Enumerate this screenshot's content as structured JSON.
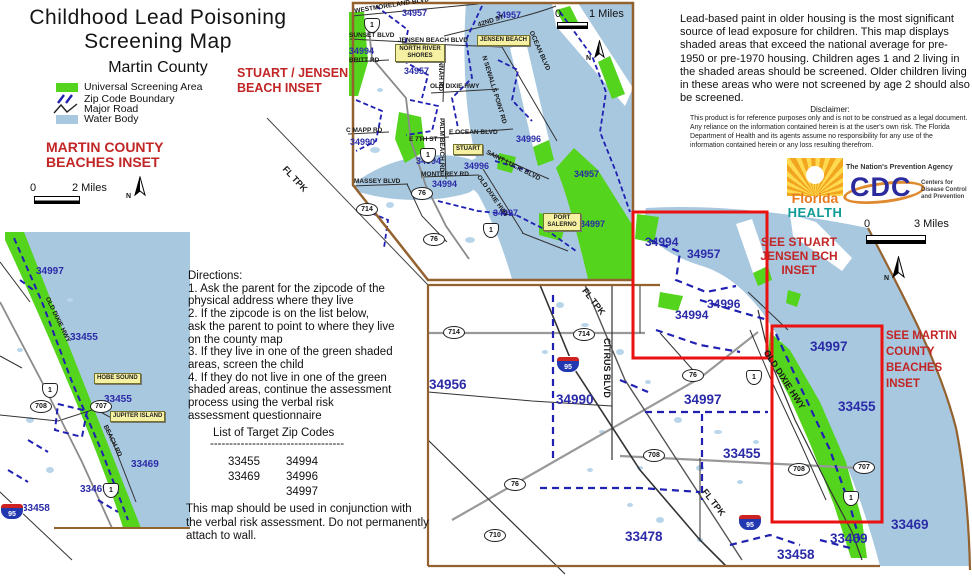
{
  "title": {
    "line1": "Childhood Lead Poisoning",
    "line2": "Screening Map",
    "subtitle": "Martin County"
  },
  "legend": {
    "universal": "Universal Screening Area",
    "zip": "Zip Code Boundary",
    "road": "Major Road",
    "water": "Water Body"
  },
  "misc": {
    "north": "N"
  },
  "beaches_inset": {
    "title1": "MARTIN COUNTY",
    "title2": "BEACHES INSET",
    "scale0": "0",
    "scale_label": "2  Miles",
    "zips": [
      "34997",
      "33455",
      "33455",
      "33469",
      "33469",
      "33458"
    ],
    "roads": [
      "OLD DIXIE HWY",
      "BEACH RD"
    ],
    "places": [
      "HOBE SOUND",
      "JUPITER ISLAND"
    ]
  },
  "stuart_inset": {
    "title1": "STUART / JENSEN",
    "title2": "BEACH INSET",
    "scale0": "0",
    "scale_label": "1  Miles",
    "zips": [
      "34957",
      "34957",
      "34994",
      "34957",
      "34990",
      "34994",
      "34996",
      "34996",
      "34994",
      "34957",
      "34997",
      "34997"
    ],
    "roads": [
      "WESTMORELAND BLVD",
      "42ND ST",
      "SUNSET BLVD",
      "JENSEN BEACH BLVD",
      "BRITT RD",
      "SAVANNAH RD",
      "OLD DIXIE HWY",
      "N SEWALLS POINT RD",
      "OCEAN BLVD",
      "C MAPP RD",
      "MASSEY BLVD",
      "E 7TH ST",
      "E OCEAN BLVD",
      "MONTEREY RD",
      "PALM BEACH RD",
      "SAINT LUCIE BLVD",
      "OLD DIXIE HWY"
    ],
    "places": [
      "NORTH RIVER SHORES",
      "JENSEN BEACH",
      "STUART",
      "PORT SALERNO"
    ]
  },
  "main_map": {
    "scale0": "0",
    "scale_label": "3  Miles",
    "zips": [
      "34956",
      "34990",
      "34994",
      "34957",
      "34996",
      "34994",
      "34997",
      "33455",
      "34997",
      "33455",
      "33478",
      "33458",
      "33469",
      "33469"
    ],
    "roads": [
      "CITRUS BLVD",
      "OLD DIXIE HWY",
      "FL TPK",
      "FL TPK",
      "FL TPK"
    ],
    "see_stuart": "SEE STUART\nJENSEN BCH\nINSET",
    "see_martin": "SEE MARTIN\nCOUNTY\nBEACHES INSET"
  },
  "shields": {
    "us1": "1",
    "i95": "95",
    "r76": "76",
    "r714": "714",
    "r708": "708",
    "r707": "707",
    "r710": "710"
  },
  "info": {
    "paragraph": "Lead-based paint in older housing is the most significant source of lead exposure for children.  This map displays shaded areas that exceed the national average for pre-1950 or pre-1970 housing.  Children ages 1 and 2 living in the shaded areas should be screened.  Older children living in these areas who were not screened by age 2 should also be screened."
  },
  "disclaimer": {
    "heading": "Disclaimer:",
    "body": "This product is for reference purposes only and is not to be construed as a legal document.  Any reliance on the information contained herein is at the user's own risk.  The Florida Department of Health and its agents assume no responsibility for any use of the information contained herein or any loss resulting therefrom."
  },
  "logos": {
    "florida_line1": "Florida",
    "florida_line2": "HEALTH",
    "cdc_tagline": "The Nation's Prevention Agency",
    "cdc": "CDC",
    "cdc_right": "Centers for Disease Control and Prevention"
  },
  "directions": {
    "text": "Directions:\n1. Ask the parent for the zipcode of the\nphysical address where they live\n2. If the zipcode is on the list below,\nask the parent to point to where they live\non the county map\n3.  If they live in one of the green shaded\nareas, screen the child\n4.  If they do not live in one of the green\nshaded areas, continue the assessment\nprocess using the verbal risk\nassessment questionnaire"
  },
  "zip_list": {
    "heading": "List of Target Zip Codes",
    "divider": "-----------------------------------",
    "rows": [
      [
        "33455",
        "34994"
      ],
      [
        "33469",
        "34996"
      ],
      [
        "",
        "34997"
      ]
    ]
  },
  "note": {
    "text": "This map should be used in conjunction with the verbal risk assessment. Do not permanently attach to wall."
  }
}
